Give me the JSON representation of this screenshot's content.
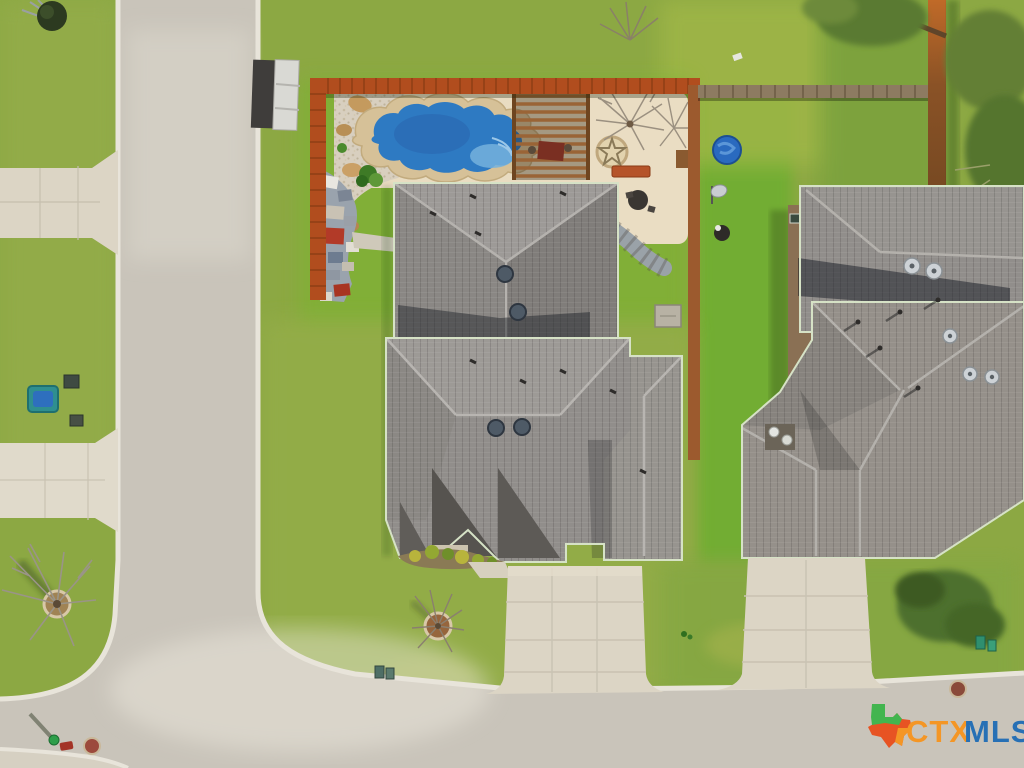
{
  "watermark": {
    "brand_ctx": "CTX",
    "brand_mls": "MLS"
  },
  "palette": {
    "grass": "#8CA843",
    "grass_bright": "#6FAE30",
    "street": "#C9C4BA",
    "curb": "#E8E4DA",
    "driveway": "#DCD5C5",
    "deck": "#E9DCC1",
    "pool_water": "#2E7AC2",
    "pool_coping": "#D6C198",
    "roof_gray": "#918E8B",
    "roof_gray_dark": "#8A8784",
    "fence_orange": "#B14D1E",
    "fence_gray": "#8D7B61",
    "ctx_orange": "#F7941E",
    "mls_blue": "#1F6CB5",
    "texas_green": "#3BB54A",
    "texas_red": "#E94E1B"
  },
  "scene": {
    "type": "aerial-drone-photo",
    "features": [
      {
        "name": "vertical-street"
      },
      {
        "name": "bottom-street"
      },
      {
        "name": "neighbor-driveway-upper"
      },
      {
        "name": "neighbor-driveway-lower"
      },
      {
        "name": "backyard-pool"
      },
      {
        "name": "pool-deck"
      },
      {
        "name": "pergola"
      },
      {
        "name": "patio-star-inlay"
      },
      {
        "name": "flagstone-path"
      },
      {
        "name": "gravel-landscape-bed"
      },
      {
        "name": "backyard-fence"
      },
      {
        "name": "storage-shed"
      },
      {
        "name": "main-house-rear-roof"
      },
      {
        "name": "main-house-front-roof"
      },
      {
        "name": "main-driveway"
      },
      {
        "name": "front-yard-tree"
      },
      {
        "name": "right-house"
      },
      {
        "name": "right-house-driveway"
      },
      {
        "name": "kiddie-pool"
      },
      {
        "name": "front-yard-bush"
      },
      {
        "name": "ctxmls-watermark"
      }
    ]
  }
}
